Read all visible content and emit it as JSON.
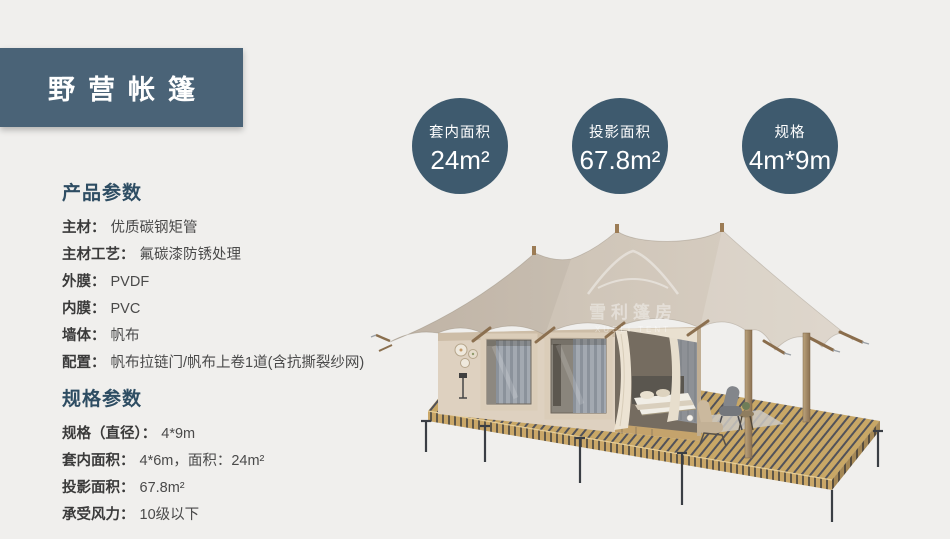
{
  "title": {
    "text": "野营帐篷"
  },
  "badges": [
    {
      "label": "套内面积",
      "value": "24m²"
    },
    {
      "label": "投影面积",
      "value": "67.8m²"
    },
    {
      "label": "规格",
      "value": "4m*9m"
    }
  ],
  "product_params": {
    "heading": "产品参数",
    "items": [
      {
        "label": "主材：",
        "value": "优质碳钢矩管"
      },
      {
        "label": "主材工艺：",
        "value": "氟碳漆防锈处理"
      },
      {
        "label": "外膜：",
        "value": "PVDF"
      },
      {
        "label": "内膜：",
        "value": "PVC"
      },
      {
        "label": "墙体：",
        "value": "帆布"
      },
      {
        "label": "配置：",
        "value": "帆布拉链门/帆布上卷1道(含抗撕裂纱网)"
      }
    ]
  },
  "spec_params": {
    "heading": "规格参数",
    "items": [
      {
        "label": "规格（直径）：",
        "value": "4*9m"
      },
      {
        "label": "套内面积：",
        "value": "4*6m，面积：24m²"
      },
      {
        "label": "投影面积：",
        "value": "67.8m²"
      },
      {
        "label": "承受风力：",
        "value": "10级以下"
      }
    ]
  },
  "watermark": {
    "cn": "雪利篷房",
    "en": "XUELI TENT"
  },
  "colors": {
    "brand": "#4a6377",
    "badge": "#3e5a6e",
    "heading": "#2e4d63",
    "page_bg": "#f0efed",
    "canvas": "#cfc5b8",
    "deck_wood": "#c8a766"
  }
}
